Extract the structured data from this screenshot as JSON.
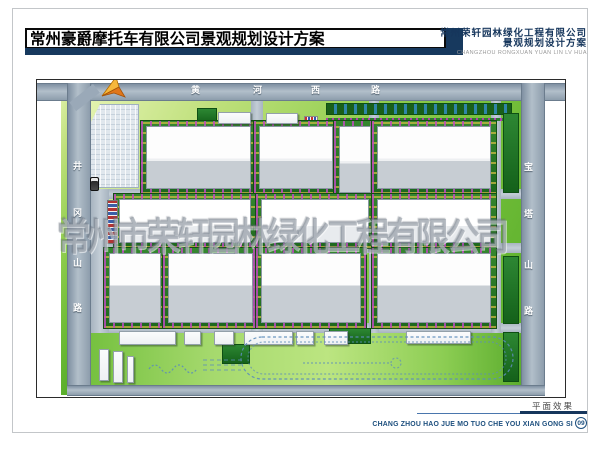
{
  "header": {
    "title": "常州豪爵摩托车有限公司景观规划设计方案",
    "company_line1": "常州荣轩园林绿化工程有限公司",
    "company_line2": "景观规划设计方案",
    "company_pinyin": "CHANGZHOU RONGXUAN YUAN LIN LV HUA"
  },
  "watermark": "常州市荣轩园林绿化工程有限公司",
  "footer": {
    "caption": "平面效果",
    "pinyin": "CHANG ZHOU HAO JUE MO TUO CHE YOU XIAN GONG SI",
    "page_number": "09"
  },
  "colors": {
    "accent_navy": "#17395e",
    "road_gray": "#a7b4c0",
    "lawn_green": "#7fc13e",
    "tree_dark_green": "#1d671d",
    "building_white": "#fdfdfd",
    "building_shadow_gray": "#c7cdd3"
  },
  "plan": {
    "road_names": [
      "黄河西路",
      "井冈山路",
      "宝塔山路"
    ],
    "names": {
      "grass": "lawn",
      "field": "test-track-lawn",
      "road": "perimeter-road",
      "iroad": "internal-road",
      "fork": "road-fork",
      "parking": "parking-lot",
      "dgreen": "tree-belt",
      "trees": "tree-row",
      "hedge": "hedge-line",
      "flowers": "flower-bed",
      "b1": "factory-building",
      "b2": "factory-building",
      "b3": "factory-building",
      "s": "small-building",
      "cars": "parked-cars",
      "bus": "bus"
    },
    "elements": [
      {
        "t": "grass",
        "x": 24,
        "y": 3,
        "w": 6,
        "h": 312
      },
      {
        "t": "grass",
        "x": 54,
        "y": 21,
        "w": 430,
        "h": 284
      },
      {
        "t": "field",
        "x": 54,
        "y": 253,
        "w": 430,
        "h": 52
      },
      {
        "t": "parking",
        "x": 52,
        "y": 24,
        "w": 50,
        "h": 84
      },
      {
        "t": "road",
        "o": "h",
        "x": 0,
        "y": 3,
        "w": 528,
        "h": 18
      },
      {
        "t": "road",
        "o": "v",
        "x": 30,
        "y": 3,
        "w": 24,
        "h": 313
      },
      {
        "t": "road",
        "o": "v",
        "x": 484,
        "y": 3,
        "w": 24,
        "h": 313
      },
      {
        "t": "road",
        "o": "h",
        "x": 30,
        "y": 305,
        "w": 478,
        "h": 11
      },
      {
        "t": "fork",
        "x": 26,
        "y": 4,
        "w": 30,
        "h": 11
      },
      {
        "t": "iroad",
        "o": "h",
        "x": 54,
        "y": 109,
        "w": 430,
        "h": 10
      },
      {
        "t": "iroad",
        "o": "h",
        "x": 54,
        "y": 163,
        "w": 430,
        "h": 10
      },
      {
        "t": "iroad",
        "o": "h",
        "x": 54,
        "y": 243,
        "w": 430,
        "h": 10
      },
      {
        "t": "iroad",
        "o": "v",
        "x": 214,
        "y": 21,
        "w": 12,
        "h": 232
      },
      {
        "t": "iroad",
        "o": "v",
        "x": 332,
        "y": 21,
        "w": 10,
        "h": 232
      },
      {
        "t": "iroad",
        "o": "v",
        "x": 454,
        "y": 21,
        "w": 10,
        "h": 232
      },
      {
        "t": "iroad",
        "o": "v",
        "x": 54,
        "y": 109,
        "w": 18,
        "h": 144
      },
      {
        "t": "trees",
        "x": 289,
        "y": 23,
        "w": 186,
        "h": 12
      },
      {
        "t": "hedge",
        "x": 289,
        "y": 38,
        "w": 186,
        "h": 3
      },
      {
        "t": "dgreen",
        "x": 466,
        "y": 33,
        "w": 16,
        "h": 80
      },
      {
        "t": "dgreen",
        "x": 466,
        "y": 176,
        "w": 16,
        "h": 68
      },
      {
        "t": "dgreen",
        "x": 466,
        "y": 252,
        "w": 16,
        "h": 50
      },
      {
        "t": "dgreen",
        "x": 160,
        "y": 28,
        "w": 20,
        "h": 16
      },
      {
        "t": "dgreen",
        "x": 292,
        "y": 248,
        "w": 42,
        "h": 16
      },
      {
        "t": "dgreen",
        "x": 185,
        "y": 264,
        "w": 28,
        "h": 20
      },
      {
        "t": "flowers",
        "x": 267,
        "y": 36,
        "w": 14,
        "h": 9
      },
      {
        "t": "b1",
        "x": 109,
        "y": 46,
        "w": 105,
        "h": 63
      },
      {
        "t": "b1",
        "x": 222,
        "y": 46,
        "w": 74,
        "h": 63
      },
      {
        "t": "b1",
        "x": 302,
        "y": 46,
        "w": 32,
        "h": 67
      },
      {
        "t": "b1",
        "x": 340,
        "y": 46,
        "w": 114,
        "h": 63
      },
      {
        "t": "b2",
        "x": 82,
        "y": 119,
        "w": 132,
        "h": 44
      },
      {
        "t": "b2",
        "x": 224,
        "y": 119,
        "w": 108,
        "h": 44
      },
      {
        "t": "b2",
        "x": 340,
        "y": 119,
        "w": 114,
        "h": 44
      },
      {
        "t": "b3",
        "x": 72,
        "y": 173,
        "w": 52,
        "h": 70
      },
      {
        "t": "b3",
        "x": 131,
        "y": 173,
        "w": 85,
        "h": 70
      },
      {
        "t": "b3",
        "x": 224,
        "y": 173,
        "w": 100,
        "h": 70
      },
      {
        "t": "b3",
        "x": 340,
        "y": 173,
        "w": 114,
        "h": 70
      },
      {
        "t": "s",
        "x": 82,
        "y": 251,
        "w": 57,
        "h": 14
      },
      {
        "t": "s",
        "x": 147,
        "y": 251,
        "w": 17,
        "h": 14
      },
      {
        "t": "s",
        "x": 177,
        "y": 251,
        "w": 20,
        "h": 14
      },
      {
        "t": "s",
        "x": 207,
        "y": 251,
        "w": 49,
        "h": 14
      },
      {
        "t": "s",
        "x": 259,
        "y": 251,
        "w": 18,
        "h": 14
      },
      {
        "t": "s",
        "x": 287,
        "y": 251,
        "w": 24,
        "h": 14
      },
      {
        "t": "s",
        "x": 369,
        "y": 251,
        "w": 65,
        "h": 13
      },
      {
        "t": "s",
        "x": 62,
        "y": 269,
        "w": 10,
        "h": 32
      },
      {
        "t": "s",
        "x": 76,
        "y": 271,
        "w": 10,
        "h": 32
      },
      {
        "t": "s",
        "x": 90,
        "y": 276,
        "w": 7,
        "h": 27
      },
      {
        "t": "s",
        "x": 181,
        "y": 32,
        "w": 33,
        "h": 12
      },
      {
        "t": "s",
        "x": 229,
        "y": 33,
        "w": 32,
        "h": 11
      },
      {
        "t": "cars",
        "x": 70,
        "y": 120,
        "w": 11,
        "h": 44
      },
      {
        "t": "bus",
        "x": 53,
        "y": 97,
        "w": 9,
        "h": 14
      }
    ],
    "road_labels": [
      {
        "t": "黄",
        "x": 154,
        "y": 6
      },
      {
        "t": "河",
        "x": 216,
        "y": 6
      },
      {
        "t": "西",
        "x": 274,
        "y": 6
      },
      {
        "t": "路",
        "x": 334,
        "y": 6
      },
      {
        "t": "井",
        "x": 36,
        "y": 82
      },
      {
        "t": "冈",
        "x": 36,
        "y": 129
      },
      {
        "t": "山",
        "x": 36,
        "y": 179
      },
      {
        "t": "路",
        "x": 36,
        "y": 224
      },
      {
        "t": "宝",
        "x": 487,
        "y": 83
      },
      {
        "t": "塔",
        "x": 487,
        "y": 130
      },
      {
        "t": "山",
        "x": 487,
        "y": 181
      },
      {
        "t": "路",
        "x": 487,
        "y": 227
      }
    ]
  }
}
